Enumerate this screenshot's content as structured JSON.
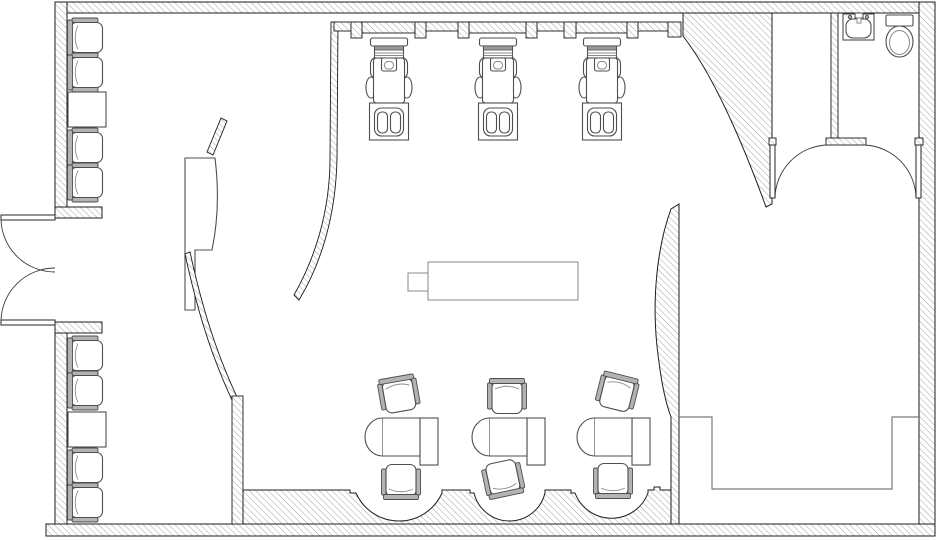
{
  "document": {
    "kind": "architectural-floor-plan",
    "subject": "salon-spa-layout",
    "visible_text": ""
  },
  "palette": {
    "bg": "#ffffff",
    "wall_outline": "#1c1c1c",
    "wall_hatch_line": "#9b9b9b",
    "furniture_stroke": "#4e4e4e",
    "furniture_light": "#8a8a8a",
    "upholstery": "#b3b3b3",
    "door_stroke": "#3a3a3a"
  },
  "plan": {
    "wall_style": "diagonal-hatch poche",
    "entrance": {
      "type": "double-swing-door",
      "leaves": 2
    },
    "waiting_area": {
      "chairs": 8,
      "side_tables": 2
    },
    "reception": {
      "desks": 1,
      "privacy_screens": 1,
      "curved_partitions": 1
    },
    "pedicure_area": {
      "stations": 3,
      "wall_pilaster_tabs": 7
    },
    "retail": {
      "display_tables": 1
    },
    "manicure_area": {
      "stations": 3,
      "chairs_per_station": 2,
      "scalloped_niches": 3
    },
    "storage_room": {
      "doors": 1
    },
    "restroom": {
      "doors": 1,
      "fixtures": [
        "sink",
        "toilet"
      ]
    },
    "lounge_room": {
      "built_in_benches": 1
    }
  }
}
